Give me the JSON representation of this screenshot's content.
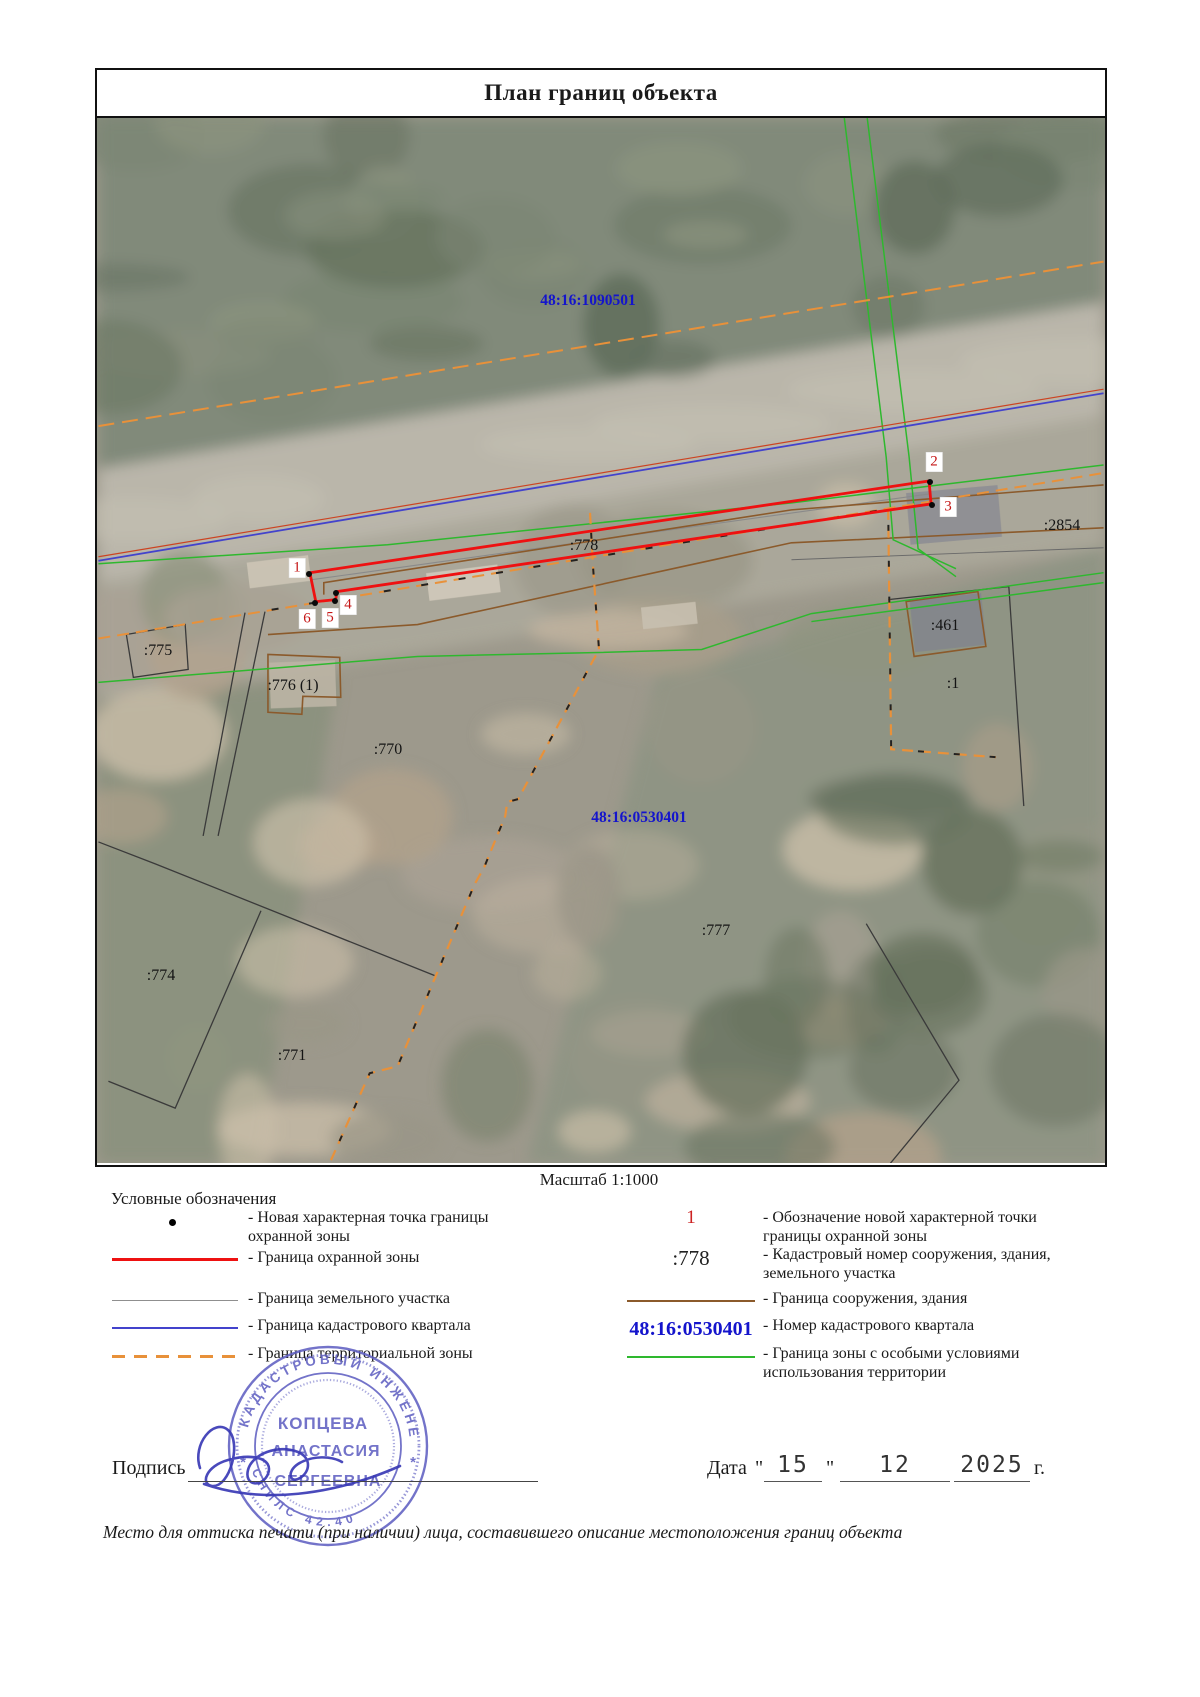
{
  "title": "План границ объекта",
  "scale_label": "Масштаб 1:1000",
  "legend": {
    "heading": "Условные обозначения",
    "left": [
      {
        "symbol": "point-dot",
        "label": "- Новая характерная точка границы охранной зоны"
      },
      {
        "symbol": "line-red",
        "label": "- Граница охранной зоны"
      },
      {
        "symbol": "line-grey",
        "label": "- Граница земельного участка"
      },
      {
        "symbol": "line-blue",
        "label": "- Граница кадастрового квартала"
      },
      {
        "symbol": "line-orange-dashed",
        "label": "- Граница территориальной зоны"
      }
    ],
    "right": [
      {
        "symbol": "red-number",
        "symbol_text": "1",
        "label": "- Обозначение новой характерной точки границы охранной зоны"
      },
      {
        "symbol": "black-text",
        "symbol_text": ":778",
        "label": "- Кадастровый номер сооружения, здания, земельного участка"
      },
      {
        "symbol": "line-brown",
        "symbol_text": "",
        "label": "- Граница сооружения, здания"
      },
      {
        "symbol": "blue-text",
        "symbol_text": "48:16:0530401",
        "label": "- Номер кадастрового квартала"
      },
      {
        "symbol": "line-green",
        "symbol_text": "",
        "label": "- Граница зоны с особыми условиями использования территории"
      }
    ]
  },
  "map": {
    "labels": [
      {
        "text": "48:16:1090501",
        "x": 491,
        "y": 183,
        "type": "quarter"
      },
      {
        "text": "48:16:0530401",
        "x": 542,
        "y": 700,
        "type": "quarter"
      },
      {
        "text": ":2854",
        "x": 965,
        "y": 408,
        "type": "parcel"
      },
      {
        "text": ":778",
        "x": 487,
        "y": 428,
        "type": "parcel"
      },
      {
        "text": ":775",
        "x": 61,
        "y": 533,
        "type": "parcel"
      },
      {
        "text": ":776 (1)",
        "x": 196,
        "y": 568,
        "type": "parcel"
      },
      {
        "text": ":461",
        "x": 848,
        "y": 508,
        "type": "parcel"
      },
      {
        "text": ":1",
        "x": 856,
        "y": 566,
        "type": "parcel"
      },
      {
        "text": ":770",
        "x": 291,
        "y": 632,
        "type": "parcel"
      },
      {
        "text": ":777",
        "x": 619,
        "y": 813,
        "type": "parcel"
      },
      {
        "text": ":774",
        "x": 64,
        "y": 858,
        "type": "parcel"
      },
      {
        "text": ":771",
        "x": 195,
        "y": 938,
        "type": "parcel"
      }
    ],
    "points": [
      {
        "n": "1",
        "x": 212,
        "y": 456,
        "lx": 200,
        "ly": 450
      },
      {
        "n": "2",
        "x": 833,
        "y": 364,
        "lx": 837,
        "ly": 344
      },
      {
        "n": "3",
        "x": 835,
        "y": 387,
        "lx": 851,
        "ly": 389
      },
      {
        "n": "4",
        "x": 239,
        "y": 475,
        "lx": 251,
        "ly": 487
      },
      {
        "n": "5",
        "x": 238,
        "y": 483,
        "lx": 233,
        "ly": 500
      },
      {
        "n": "6",
        "x": 218,
        "y": 485,
        "lx": 210,
        "ly": 501
      }
    ]
  },
  "signature": {
    "label": "Подпись"
  },
  "date": {
    "label": "Дата",
    "open_quote": "\"",
    "day": "15",
    "close_quote": "\"",
    "month": "12",
    "year": "2025",
    "suffix": "г."
  },
  "footer_note": "Место для оттиска печати (при наличии) лица, составившего описание местоположения границ объекта",
  "stamp": {
    "ring_top": "КАДАСТРОВЫЙ ИНЖЕНЕР",
    "ring_bottom": "СНИЛС   42.40",
    "name_line1": "КОПЦЕВА",
    "name_line2": "АНАСТАСИЯ",
    "name_line3": "СЕРГЕЕВНА",
    "side_mark": "*"
  },
  "colors": {
    "boundary_red": "#ee1111",
    "quarter_blue": "#4343cc",
    "zone_green": "#2eb82e",
    "territorial_orange": "#e8913a",
    "structure_brown": "#8b5a2b",
    "parcel_grey": "#555555",
    "label_blue": "#1414cc",
    "point_red": "#c51616",
    "stamp_blue": "#6060c2"
  }
}
